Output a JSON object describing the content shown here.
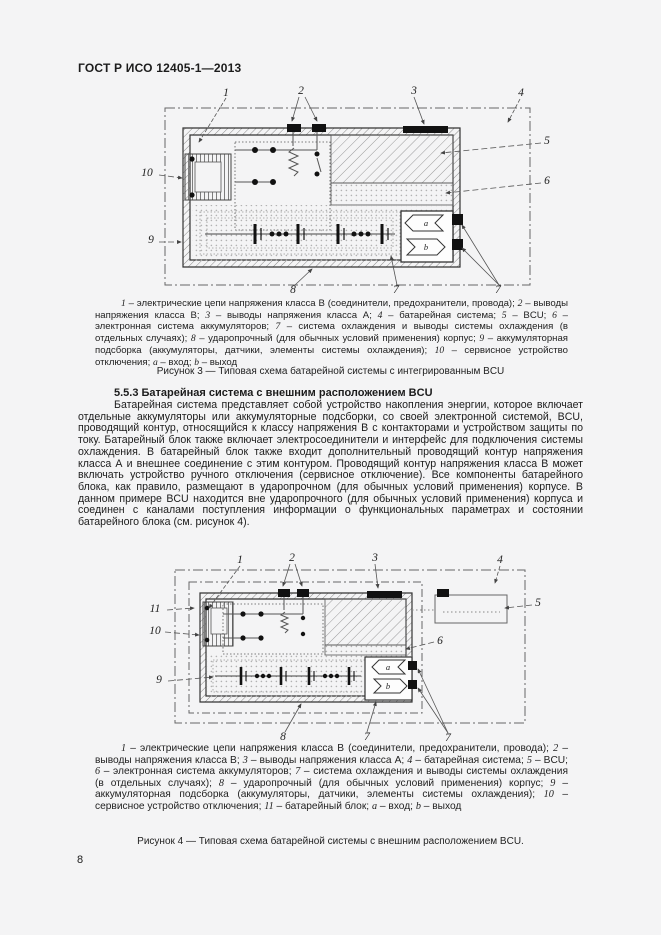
{
  "page": {
    "header": "ГОСТ Р ИСО 12405-1—2013",
    "page_number": "8"
  },
  "section": {
    "heading": "5.5.3 Батарейная система с внешним расположением BCU",
    "paragraph": "Батарейная система представляет собой устройство накопления энергии, которое включает отдельные аккумуляторы или аккумуляторные подсборки, со своей электронной системой, BCU, проводящий контур, относящийся к классу напряжения В с контакторами и устройством защиты по току. Батарейный блок также включает электросоединители и интерфейс для подключения системы охлаждения. В батарейный блок также входит дополнительный проводящий контур напряжения класса А и внешнее соединение с этим контуром. Проводящий контур напряжения класса В может включать устройство ручного отключения (сервисное отключение). Все компоненты батарейного блока, как правило, размещают в ударопрочном (для обычных условий применения) корпусе. В данном примере BCU находится вне ударопрочного (для обычных условий применения) корпуса и соединен с каналами поступления информации о функциональных параметрах и состоянии батарейного блока (см. рисунок 4)."
  },
  "figure3": {
    "title": "Рисунок 3 — Типовая схема батарейной системы с интегрированным BCU",
    "callouts": [
      {
        "label": "1",
        "x": 131,
        "y": 9
      },
      {
        "label": "2",
        "x": 206,
        "y": 7
      },
      {
        "label": "3",
        "x": 319,
        "y": 7
      },
      {
        "label": "4",
        "x": 426,
        "y": 9
      },
      {
        "label": "5",
        "x": 452,
        "y": 57
      },
      {
        "label": "6",
        "x": 452,
        "y": 97
      },
      {
        "label": "8",
        "x": 198,
        "y": 206
      },
      {
        "label": "7",
        "x": 301,
        "y": 206
      },
      {
        "label": "7",
        "x": 403,
        "y": 206
      },
      {
        "label": "9",
        "x": 56,
        "y": 156
      },
      {
        "label": "10",
        "x": 52,
        "y": 89
      },
      {
        "label": "a",
        "x": 331,
        "y": 139,
        "small": true
      },
      {
        "label": "b",
        "x": 331,
        "y": 163,
        "small": true
      }
    ],
    "legend": [
      {
        "num": "1",
        "text": " – электрические цепи напряжения класса В (соединители, предохранители, провода); "
      },
      {
        "num": "2",
        "text": " – выводы напряжения класса В; "
      },
      {
        "num": "3",
        "text": " – выводы напряжения класса А; "
      },
      {
        "num": "4",
        "text": " – батарейная система; "
      },
      {
        "num": "5",
        "text": " – BCU; "
      },
      {
        "num": "6",
        "text": " – электронная система аккумуляторов; "
      },
      {
        "num": "7",
        "text": " – система охлаждения и выводы системы охлаждения (в отдельных случаях); "
      },
      {
        "num": "8",
        "text": " – ударопрочный (для обычных условий применения) корпус; "
      },
      {
        "num": "9",
        "text": " – аккумуляторная подсборка (аккумуляторы, датчики, элементы системы охлаждения); "
      },
      {
        "num": "10",
        "text": " – сервисное устройство отключения; "
      },
      {
        "num": "a",
        "text": " – вход; "
      },
      {
        "num": "b",
        "text": " – выход"
      }
    ]
  },
  "figure4": {
    "title": "Рисунок 4 — Типовая схема батарейной системы с внешним расположением BCU.",
    "callouts": [
      {
        "label": "1",
        "x": 145,
        "y": 10
      },
      {
        "label": "2",
        "x": 197,
        "y": 8
      },
      {
        "label": "3",
        "x": 280,
        "y": 8
      },
      {
        "label": "4",
        "x": 405,
        "y": 10
      },
      {
        "label": "5",
        "x": 443,
        "y": 53
      },
      {
        "label": "6",
        "x": 345,
        "y": 91
      },
      {
        "label": "8",
        "x": 188,
        "y": 187
      },
      {
        "label": "7",
        "x": 272,
        "y": 187
      },
      {
        "label": "7",
        "x": 353,
        "y": 188
      },
      {
        "label": "9",
        "x": 64,
        "y": 130
      },
      {
        "label": "10",
        "x": 60,
        "y": 81
      },
      {
        "label": "11",
        "x": 60,
        "y": 59
      },
      {
        "label": "a",
        "x": 293,
        "y": 117,
        "small": true
      },
      {
        "label": "b",
        "x": 293,
        "y": 136,
        "small": true
      }
    ],
    "legend": [
      {
        "num": "1",
        "text": " – электрические цепи напряжения класса В (соединители, предохранители, провода); "
      },
      {
        "num": "2",
        "text": " – выводы напряжения класса В; "
      },
      {
        "num": "3",
        "text": " – выводы напряжения класса А; "
      },
      {
        "num": "4",
        "text": " – батарейная система; "
      },
      {
        "num": "5",
        "text": " – BCU; "
      },
      {
        "num": "6",
        "text": " – электронная система аккумуляторов; "
      },
      {
        "num": "7",
        "text": " – система охлаждения и выводы системы охлаждения (в отдельных случаях); "
      },
      {
        "num": "8",
        "text": " – ударопрочный (для обычных условий применения) корпус; "
      },
      {
        "num": "9",
        "text": " – аккумуляторная подсборка (аккумуляторы, датчики, элементы системы охлаждения); "
      },
      {
        "num": "10",
        "text": " – сервисное устройство отключения; "
      },
      {
        "num": "11",
        "text": " – батарейный блок; "
      },
      {
        "num": "a",
        "text": " – вход; "
      },
      {
        "num": "b",
        "text": " – выход"
      }
    ]
  }
}
